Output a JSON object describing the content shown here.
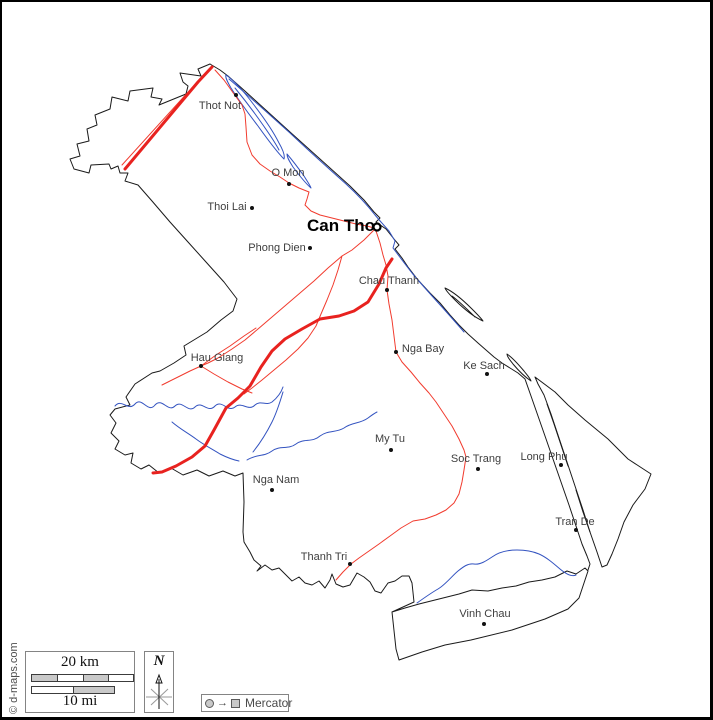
{
  "copyright": "© d-maps.com",
  "capital": {
    "name": "Can Tho"
  },
  "cities": [
    {
      "name": "Thot Not"
    },
    {
      "name": "O Mon"
    },
    {
      "name": "Thoi Lai"
    },
    {
      "name": "Phong Dien"
    },
    {
      "name": "Chau Thanh"
    },
    {
      "name": "Hau Giang"
    },
    {
      "name": "Nga Bay"
    },
    {
      "name": "Ke Sach"
    },
    {
      "name": "My Tu"
    },
    {
      "name": "Soc Trang"
    },
    {
      "name": "Long Phu"
    },
    {
      "name": "Nga Nam"
    },
    {
      "name": "Tran De"
    },
    {
      "name": "Thanh Tri"
    },
    {
      "name": "Vinh Chau"
    }
  ],
  "scale": {
    "km_label": "20 km",
    "mi_label": "10 mi"
  },
  "compass": {
    "north_label": "N"
  },
  "legend": {
    "projection_label": "Mercator"
  },
  "colors": {
    "border": "#1a1a1a",
    "river": "#3353c0",
    "road_major": "#e8221f",
    "road_minor": "#f13b2e",
    "label": "#3e3e3e"
  }
}
